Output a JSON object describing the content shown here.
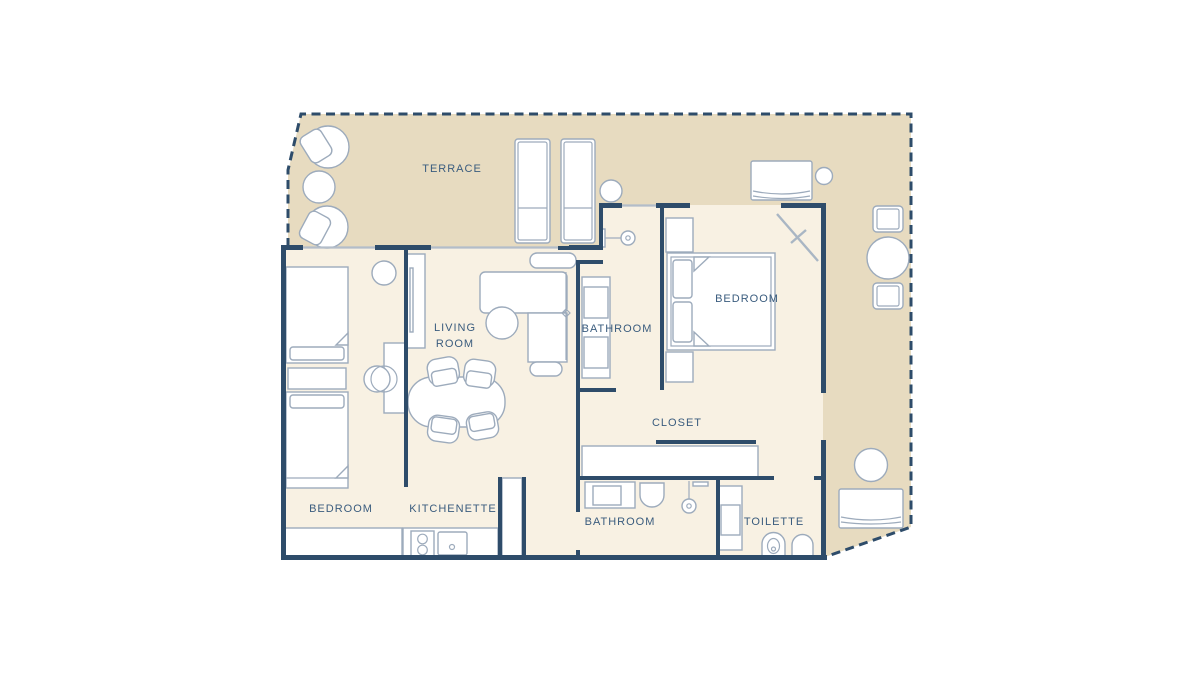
{
  "page": {
    "background": "#ffffff",
    "type": "apartment-floor-plan"
  },
  "colors": {
    "wall": "#2e4c6a",
    "terrace_fill": "#e7dbc0",
    "interior_fill": "#f8f1e3",
    "furniture_stroke": "#9dabbc",
    "label_text": "#3a5c7e",
    "window_line": "#b3bdc9",
    "dashed_boundary": "#2e4c6a"
  },
  "rooms": {
    "terrace": {
      "label": "TERRACE"
    },
    "living_room": {
      "label_line1": "LIVING",
      "label_line2": "ROOM"
    },
    "bathroom_upper": {
      "label": "BATHROOM"
    },
    "bedroom_main": {
      "label": "BEDROOM"
    },
    "closet": {
      "label": "CLOSET"
    },
    "bedroom_second": {
      "label": "BEDROOM"
    },
    "kitchenette": {
      "label": "KITCHENETTE"
    },
    "bathroom_lower": {
      "label": "BATHROOM"
    },
    "toilette": {
      "label": "TOILETTE"
    }
  },
  "furniture": {
    "terrace": [
      "armchair",
      "round-table",
      "armchair",
      "sun-lounger",
      "sun-lounger",
      "side-table",
      "daybed",
      "side-table",
      "terrace-chair",
      "round-dining-table",
      "terrace-chair",
      "round-table",
      "daybed"
    ],
    "bedroom_second": [
      "single-bed",
      "nightstand",
      "single-bed",
      "stool",
      "desk",
      "desk-chair",
      "wardrobe"
    ],
    "living_room": [
      "tv-console",
      "corner-sofa",
      "coffee-table",
      "dining-table",
      "dining-chair",
      "dining-chair",
      "dining-chair",
      "dining-chair"
    ],
    "kitchenette": [
      "counter",
      "stove",
      "sink",
      "fridge"
    ],
    "bathroom_upper": [
      "double-sink-vanity",
      "shower-head"
    ],
    "bedroom_main": [
      "wardrobe-shelf",
      "double-bed",
      "nightstand",
      "open-terrace-door"
    ],
    "closet": [
      "wardrobe-counter"
    ],
    "bathroom_lower": [
      "sink-vanity",
      "toilet",
      "shower-head"
    ],
    "toilette": [
      "shower-tray",
      "bidet",
      "toilet"
    ]
  }
}
